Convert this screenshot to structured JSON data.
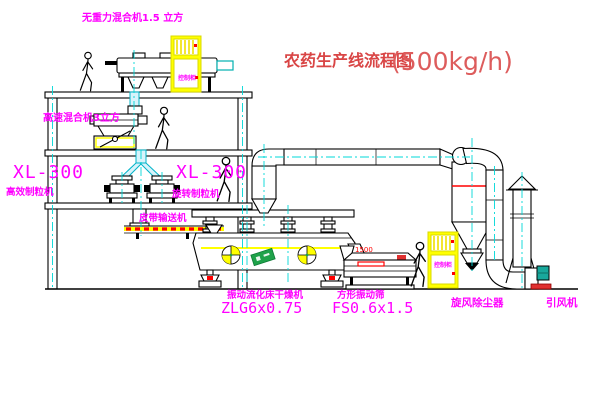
{
  "title": {
    "name": "农药生产线流程图",
    "capacity": "(500kg/h)"
  },
  "equipment_labels": {
    "gravity_mixer": "无重力混合机1.5 立方",
    "high_speed_mixer": "高速混合机3立方",
    "granulator_left": {
      "model": "XL-300",
      "name": "高效制粒机"
    },
    "granulator_right": {
      "model": "XL-300",
      "name": "旋转制粒机"
    },
    "belt_conveyor": "皮带输送机",
    "fluid_bed_dryer": {
      "name": "振动流化床干燥机",
      "model": "ZLG6x0.75"
    },
    "square_screen": {
      "name": "方形振动筛",
      "model": "FS0.6x1.5"
    },
    "cyclone": "旋风除尘器",
    "induced_draft_fan": "引风机",
    "control_cabinet": "控制柜",
    "screen_dimension": "1500"
  },
  "colors": {
    "label_magenta": "#ff00ff",
    "title_red": "#d94545",
    "centerline_cyan": "#00d8d8",
    "cabinet_yellow": "#ffff00",
    "accent_red": "#ff0000",
    "motor_teal": "#18a89c",
    "logo_green": "#1fa24a",
    "chute_cyan": "#d8f3fb",
    "line_black": "#000000"
  }
}
